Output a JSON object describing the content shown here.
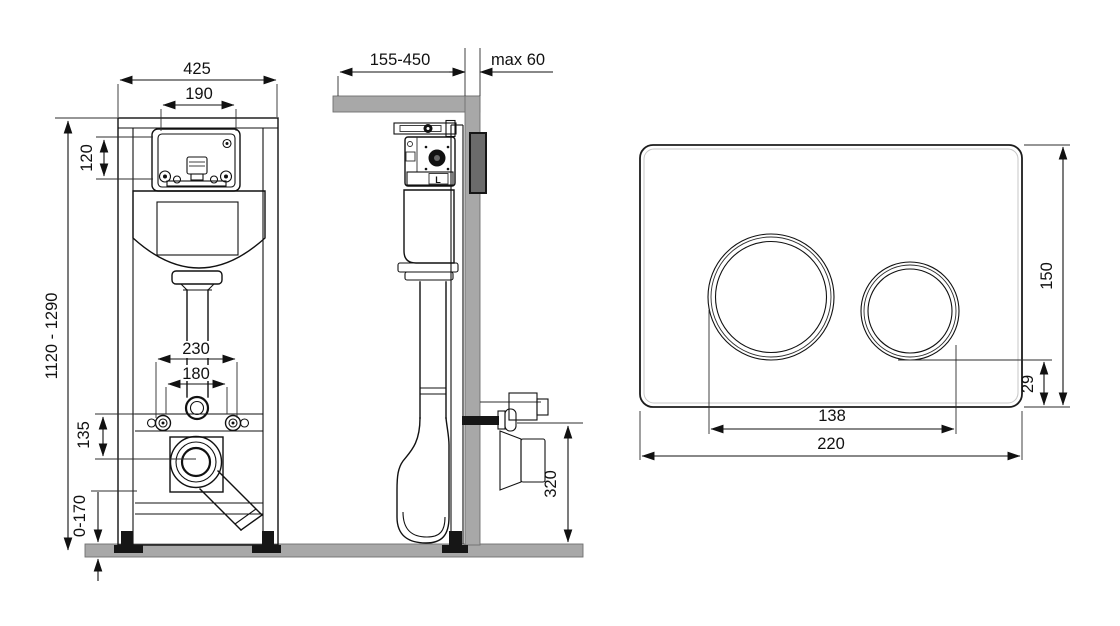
{
  "drawing_title": "wall-hung-wc-installation-frame-technical-drawing",
  "colors": {
    "line": "#111111",
    "structure_gray": "#a8a8a8",
    "background": "#ffffff"
  },
  "front_view": {
    "overall_width": "425",
    "service_opening_width": "190",
    "service_opening_height": "120",
    "frame_height_range": "1120 - 1290",
    "fixing_span_outer": "230",
    "fixing_span_inner": "180",
    "outlet_center_offset": "135",
    "feet_adjustment_range": "0-170"
  },
  "side_view": {
    "installation_depth_range": "155-450",
    "max_front_wall_thickness": "max 60",
    "outlet_height": "320"
  },
  "flush_plate_view": {
    "plate_height": "150",
    "button_bottom_offset": "29",
    "button_span": "138",
    "plate_width": "220"
  }
}
